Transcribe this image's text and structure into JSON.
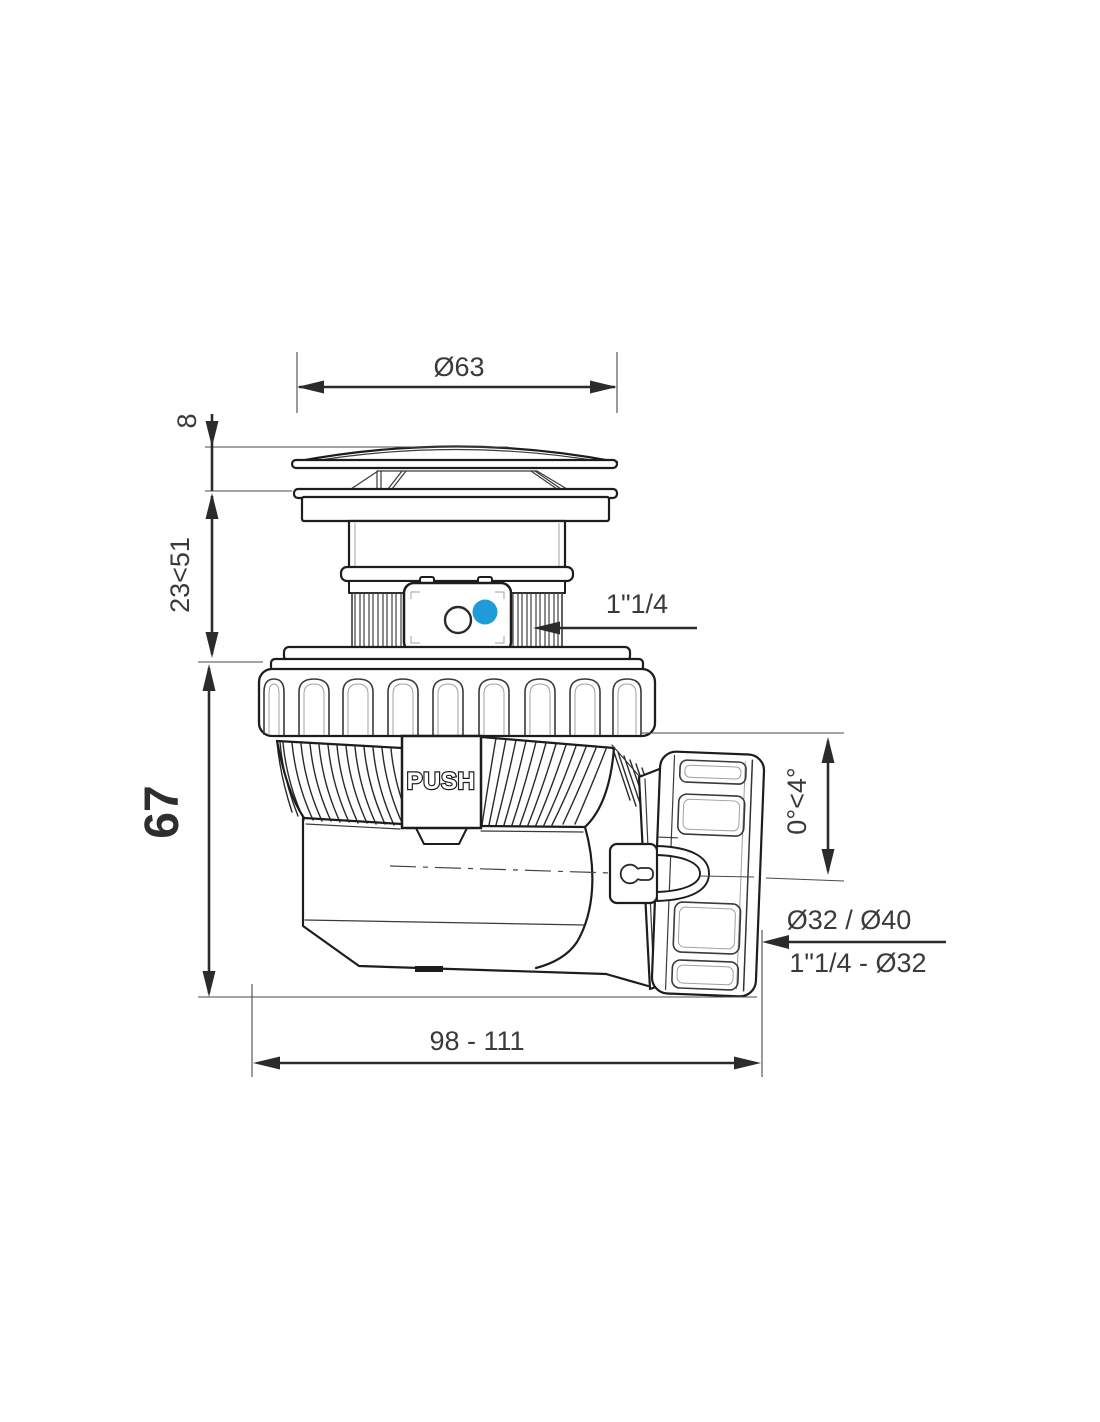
{
  "drawing": {
    "type": "technical-drawing",
    "subject": "push-open waste trap side view",
    "labels": {
      "push": "PUSH"
    },
    "dimensions": {
      "cap_diameter": "Ø63",
      "cap_height": "8",
      "adjust_height": "23<51",
      "body_height": "67",
      "inlet_thread": "1\"1/4",
      "outlet_angle": "0°<4°",
      "outlet_sizes": "Ø32 / Ø40",
      "outlet_thread": "1\"1/4 - Ø32",
      "overall_length": "98 - 111"
    },
    "colors": {
      "line": "#1d1d1b",
      "dimension": "#2b2b2b",
      "accent_blue": "#1f9cd8",
      "background": "#ffffff"
    }
  }
}
